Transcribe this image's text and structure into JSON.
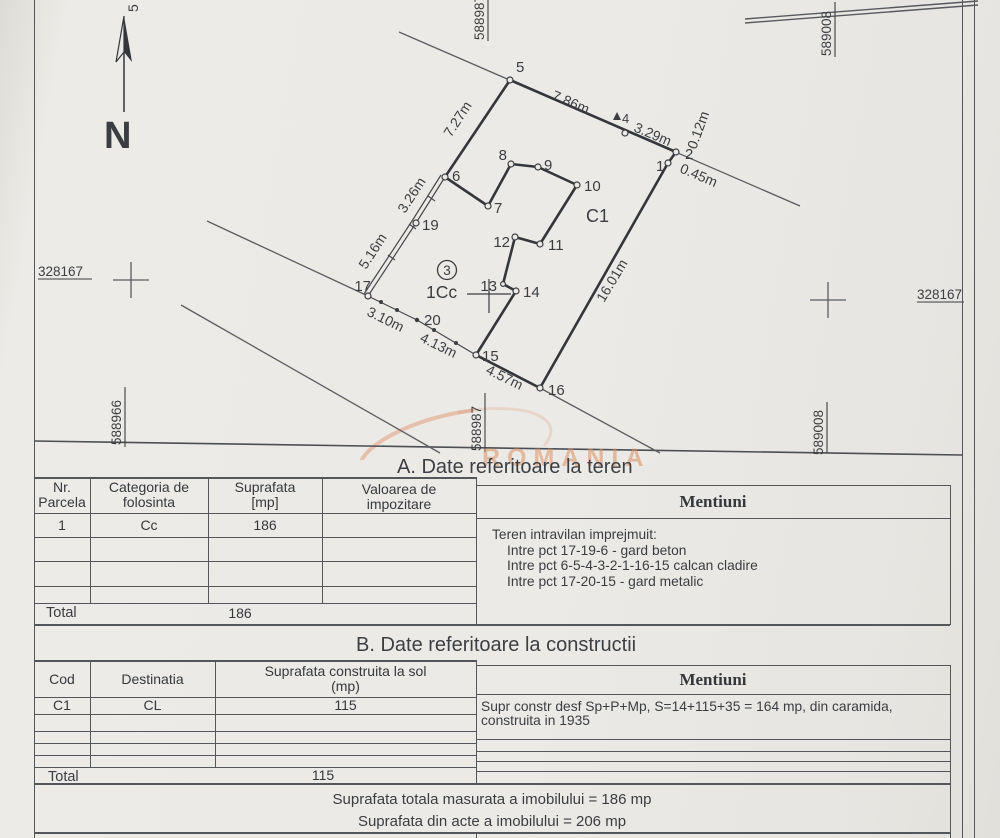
{
  "plan": {
    "north": "N",
    "edge_cut_label": "5",
    "coords": {
      "left_x": "328167",
      "right_x": "328167",
      "bottom_left_y": "588966",
      "bottom_center_y": "588987",
      "top_center_y": "588987",
      "top_right_y": "589008",
      "bottom_right_y": "589008"
    },
    "labels": {
      "building": "C1",
      "parcel": "1Cc",
      "parcel_no": "3"
    },
    "points": {
      "1": "1",
      "2": "2",
      "4": "4",
      "5": "5",
      "6": "6",
      "7": "7",
      "8": "8",
      "9": "9",
      "10": "10",
      "11": "11",
      "12": "12",
      "13": "13",
      "14": "14",
      "15": "15",
      "16": "16",
      "17": "17",
      "19": "19",
      "20": "20"
    },
    "measurements": {
      "seg_5_4": "7.86m",
      "seg_4_2": "3.29m",
      "seg_2_offset": "0.12m",
      "seg_2_1": "0.45m",
      "seg_5_6": "7.27m",
      "seg_6_19": "3.26m",
      "seg_19_17": "5.16m",
      "seg_17_20": "3.10m",
      "seg_20_15": "4.13m",
      "seg_15_16": "4.57m",
      "seg_1_16": "16.01m"
    }
  },
  "watermark_text": "ROMANIA",
  "section_a": {
    "title": "A. Date referitoare la teren",
    "headers": {
      "c1a": "Nr.",
      "c1b": "Parcela",
      "c2a": "Categoria de",
      "c2b": "folosinta",
      "c3a": "Suprafata",
      "c3b": "[mp]",
      "c4a": "Valoarea de",
      "c4b": "impozitare",
      "c5": "Mentiuni"
    },
    "row": {
      "nr": "1",
      "categoria": "Cc",
      "suprafata": "186"
    },
    "total_label": "Total",
    "total_value": "186",
    "mentiuni_lines": [
      "Teren intravilan imprejmuit:",
      "Intre pct 17-19-6 - gard beton",
      "Intre pct 6-5-4-3-2-1-16-15 calcan cladire",
      "Intre pct 17-20-15 - gard metalic"
    ]
  },
  "section_b": {
    "title": "B. Date referitoare la constructii",
    "headers": {
      "c1": "Cod",
      "c2": "Destinatia",
      "c3a": "Suprafata construita la sol",
      "c3b": "(mp)",
      "c4": "Mentiuni"
    },
    "row": {
      "cod": "C1",
      "destinatia": "CL",
      "suprafata": "115"
    },
    "total_label": "Total",
    "total_value": "115",
    "mentiuni_lines": [
      "Supr constr desf Sp+P+Mp, S=14+115+35 = 164 mp, din caramida,",
      "construita in 1935"
    ]
  },
  "summary": {
    "line1": "Suprafata totala masurata a imobilului = 186 mp",
    "line2": "Suprafata din acte a imobilului = 206 mp"
  }
}
